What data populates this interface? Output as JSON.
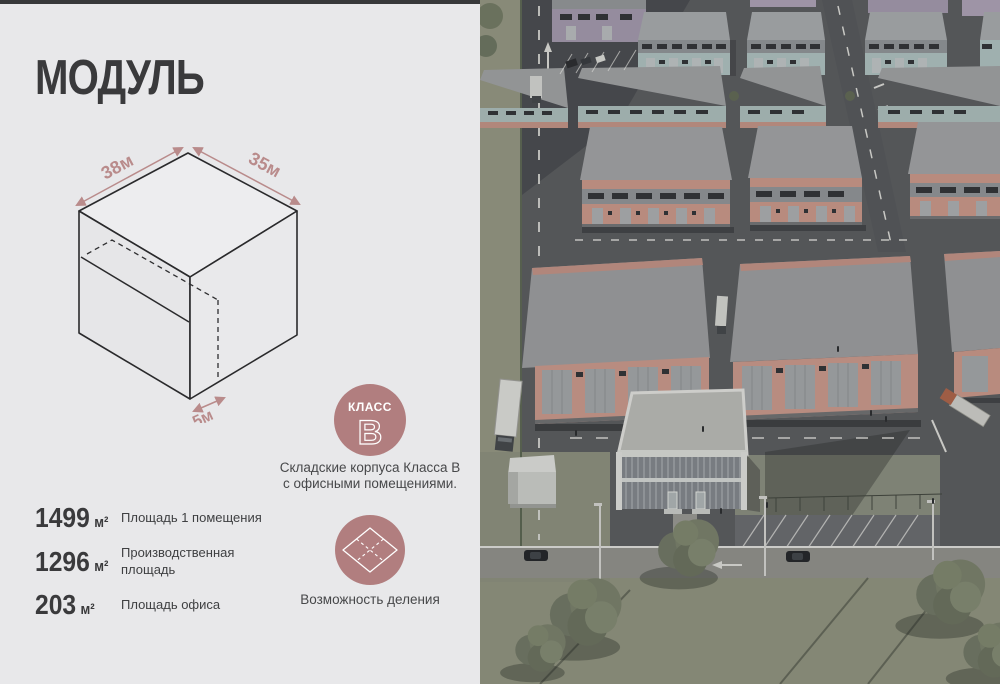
{
  "slide": {
    "title": "МОДУЛЬ"
  },
  "colors": {
    "panel_bg": "#e8e8ea",
    "ink": "#3a3a3c",
    "accent_rose": "#b98b8b",
    "badge_rose": "#b17e7f",
    "render_asphalt": "#55575a",
    "render_grass": "#8f917d",
    "render_roof_gray": "#9b9d9f",
    "render_teal_facade": "#a9bcba",
    "render_orange_facade": "#c59284",
    "render_purple_facade": "#9d94a8"
  },
  "diagram": {
    "width_label": "38м",
    "depth_label": "35м",
    "office_label": "5м"
  },
  "class_badge": {
    "label": "КЛАСС",
    "letter": "B",
    "caption": "Складские корпуса Класса В с офисными помещениями."
  },
  "division": {
    "caption": "Возможность деления"
  },
  "stats": [
    {
      "value": "1499",
      "unit": "м²",
      "label": "Площадь 1 помещения"
    },
    {
      "value": "1296",
      "unit": "м²",
      "label": "Производственная площадь"
    },
    {
      "value": "203",
      "unit": "м²",
      "label": "Площадь офиса"
    }
  ]
}
